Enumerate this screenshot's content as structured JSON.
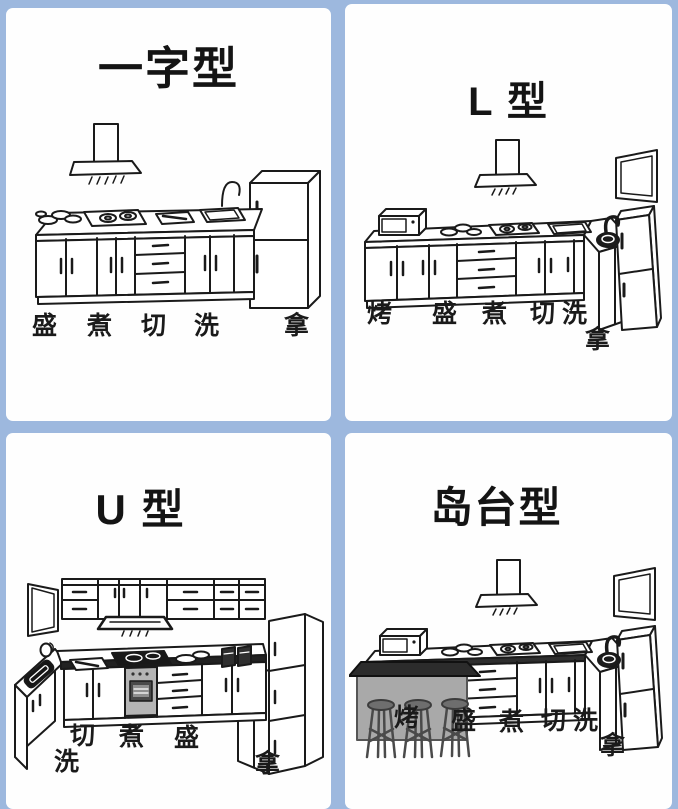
{
  "colors": {
    "frame_blue": "#9db8de",
    "panel_white": "#fefefe",
    "ink": "#1a1a1a",
    "island_body_gray": "#a9a9a9",
    "island_top_dark": "#2c2c2c",
    "oven_gray": "#b5b5b5"
  },
  "panels": [
    {
      "id": "straight-line",
      "title": "一字型",
      "labels": [
        "盛",
        "煮",
        "切",
        "洗",
        "拿"
      ]
    },
    {
      "id": "l-shape",
      "title": "L 型",
      "labels": [
        "烤",
        "盛",
        "煮",
        "切",
        "洗",
        "拿"
      ]
    },
    {
      "id": "u-shape",
      "title": "U 型",
      "labels": [
        "切",
        "煮",
        "盛",
        "洗",
        "拿"
      ]
    },
    {
      "id": "island",
      "title": "岛台型",
      "labels": [
        "烤",
        "盛",
        "煮",
        "切",
        "洗",
        "拿"
      ]
    }
  ]
}
